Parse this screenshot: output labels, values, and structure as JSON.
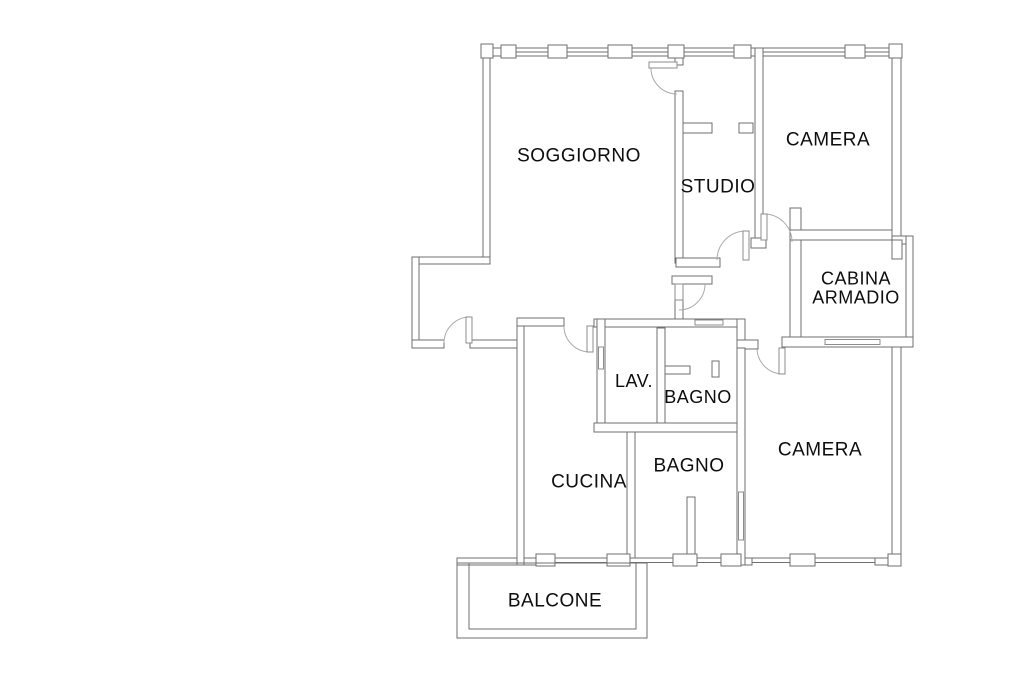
{
  "canvas": {
    "width": 1024,
    "height": 682,
    "background": "#ffffff"
  },
  "style": {
    "wall_fill": "#ffffff",
    "wall_stroke": "#6f6f6f",
    "arc_stroke": "#aaaaaa",
    "leaf_stroke": "#8c8c8c",
    "label_color": "#0d0d0d",
    "label_font_size": 19
  },
  "rooms": [
    {
      "id": "soggiorno",
      "label": "SOGGIORNO",
      "x": 579,
      "y": 156,
      "size": 19
    },
    {
      "id": "studio",
      "label": "STUDIO",
      "x": 718,
      "y": 187,
      "size": 19
    },
    {
      "id": "camera-top",
      "label": "CAMERA",
      "x": 828,
      "y": 140,
      "size": 19
    },
    {
      "id": "cabina-armadio",
      "label": "CABINA ARMADIO",
      "lines": [
        "CABINA",
        "ARMADIO"
      ],
      "x": 856,
      "y": 288,
      "line_height": 19,
      "size": 18
    },
    {
      "id": "lav",
      "label": "LAV.",
      "x": 634,
      "y": 381,
      "size": 18
    },
    {
      "id": "bagno-small",
      "label": "BAGNO",
      "x": 698,
      "y": 397,
      "size": 18
    },
    {
      "id": "cucina",
      "label": "CUCINA",
      "x": 589,
      "y": 482,
      "size": 19
    },
    {
      "id": "bagno-bottom",
      "label": "BAGNO",
      "x": 689,
      "y": 466,
      "size": 19
    },
    {
      "id": "camera-bottom",
      "label": "CAMERA",
      "x": 820,
      "y": 450,
      "size": 19
    },
    {
      "id": "balcone",
      "label": "BALCONE",
      "x": 555,
      "y": 601,
      "size": 19
    }
  ],
  "floorplan": {
    "walls": [
      {
        "n": "top-window-band",
        "r": [
          483,
          48,
          418,
          8
        ]
      },
      {
        "n": "bottom-wall-left",
        "r": [
          457,
          558,
          79,
          7
        ]
      },
      {
        "n": "bottom-wall-mid",
        "r": [
          723,
          558,
          29,
          7
        ]
      },
      {
        "n": "bottom-wall-right",
        "r": [
          875,
          558,
          25,
          7
        ]
      },
      {
        "n": "left-exterior-wall",
        "r": [
          483,
          48,
          7,
          214
        ]
      },
      {
        "n": "entry-north-wall",
        "r": [
          412,
          257,
          78,
          7
        ]
      },
      {
        "n": "entry-west-wall",
        "r": [
          412,
          257,
          7,
          90
        ]
      },
      {
        "n": "entry-south-wall-a",
        "r": [
          412,
          340,
          32,
          8
        ]
      },
      {
        "n": "entry-south-wall-b",
        "r": [
          470,
          340,
          53,
          8
        ]
      },
      {
        "n": "cucina-west-wall",
        "r": [
          517,
          318,
          7,
          247
        ]
      },
      {
        "n": "cucina-north-wall",
        "r": [
          517,
          318,
          47,
          8
        ]
      },
      {
        "n": "lav-bagno-north-wall",
        "r": [
          594,
          319,
          151,
          8
        ]
      },
      {
        "n": "lav-west-wall",
        "r": [
          597,
          319,
          8,
          113
        ]
      },
      {
        "n": "lav-bagno-divider",
        "r": [
          657,
          328,
          8,
          104
        ]
      },
      {
        "n": "lav-bagno-south-wall",
        "r": [
          594,
          423,
          151,
          9
        ]
      },
      {
        "n": "cucina-bagno-divider",
        "r": [
          627,
          432,
          8,
          131
        ]
      },
      {
        "n": "soggiorno-east-cap",
        "r": [
          675,
          48,
          8,
          17
        ]
      },
      {
        "n": "soggiorno-east-wall",
        "r": [
          675,
          91,
          8,
          172
        ]
      },
      {
        "n": "studio-south-wall",
        "r": [
          676,
          258,
          44,
          9
        ]
      },
      {
        "n": "hall-north-wall",
        "r": [
          672,
          276,
          40,
          8
        ]
      },
      {
        "n": "hall-stub-wall",
        "r": [
          675,
          298,
          8,
          21
        ]
      },
      {
        "n": "studio-east-wall",
        "r": [
          755,
          48,
          8,
          190
        ]
      },
      {
        "n": "studio-east-wall-cap",
        "r": [
          751,
          238,
          15,
          10
        ]
      },
      {
        "n": "cabina-west-wall",
        "r": [
          790,
          208,
          11,
          139
        ]
      },
      {
        "n": "camera-top-south-wall",
        "r": [
          790,
          230,
          106,
          10
        ]
      },
      {
        "n": "right-exterior-upper",
        "r": [
          892,
          48,
          9,
          190
        ]
      },
      {
        "n": "right-jut-wall",
        "r": [
          892,
          236,
          21,
          8
        ]
      },
      {
        "n": "cabina-east-wall",
        "r": [
          906,
          236,
          7,
          111
        ]
      },
      {
        "n": "cabina-notch-pier",
        "r": [
          892,
          240,
          10,
          19
        ]
      },
      {
        "n": "cabina-south-wall",
        "r": [
          782,
          337,
          131,
          10
        ]
      },
      {
        "n": "right-exterior-lower",
        "r": [
          892,
          347,
          9,
          218
        ]
      },
      {
        "n": "bagno-east-wall-top",
        "r": [
          737,
          319,
          8,
          29
        ]
      },
      {
        "n": "camera-bottom-jut",
        "r": [
          737,
          340,
          21,
          9
        ]
      },
      {
        "n": "bagno-camera-wall",
        "r": [
          737,
          348,
          8,
          217
        ]
      },
      {
        "n": "studio-stub-left",
        "r": [
          683,
          123,
          29,
          10
        ]
      },
      {
        "n": "studio-stub-right",
        "r": [
          739,
          123,
          14,
          10
        ]
      },
      {
        "n": "bagno-small-stub-h",
        "r": [
          665,
          366,
          25,
          8
        ]
      },
      {
        "n": "bagno-small-stub-v",
        "r": [
          712,
          361,
          7,
          16
        ]
      },
      {
        "n": "bagno-bottom-stub",
        "r": [
          687,
          497,
          8,
          61
        ]
      }
    ],
    "piers_top": [
      [
        481,
        44,
        12,
        14
      ],
      [
        501,
        45,
        15,
        13
      ],
      [
        548,
        45,
        19,
        13
      ],
      [
        608,
        45,
        24,
        13
      ],
      [
        668,
        45,
        16,
        13
      ],
      [
        734,
        45,
        17,
        13
      ],
      [
        845,
        45,
        20,
        13
      ],
      [
        889,
        44,
        13,
        14
      ]
    ],
    "piers_bottom": [
      [
        536,
        554,
        19,
        12
      ],
      [
        607,
        554,
        23,
        12
      ],
      [
        673,
        554,
        24,
        12
      ],
      [
        721,
        554,
        20,
        12
      ],
      [
        790,
        554,
        25,
        12
      ],
      [
        888,
        554,
        13,
        12
      ]
    ],
    "glaze_top_y": 52,
    "glaze_top_segments": [
      [
        513,
        548
      ],
      [
        567,
        608
      ],
      [
        632,
        668
      ],
      [
        684,
        734
      ],
      [
        763,
        845
      ],
      [
        865,
        889
      ]
    ],
    "windows_bottom_y": 558,
    "windows_bottom": [
      [
        555,
        52
      ],
      [
        630,
        43
      ],
      [
        697,
        24
      ],
      [
        752,
        38
      ],
      [
        815,
        60
      ]
    ],
    "balcony": {
      "outer": [
        457,
        563,
        190,
        75
      ],
      "inner": [
        469,
        563,
        167,
        66
      ]
    },
    "sliding_doors": [
      {
        "n": "lav-pocket-door",
        "r": [
          598.5,
          347,
          5,
          22
        ]
      },
      {
        "n": "bagno-sliding-door",
        "r": [
          695,
          320,
          28,
          5
        ]
      },
      {
        "n": "cabina-sliding-door",
        "r": [
          825,
          339.5,
          55,
          5
        ]
      },
      {
        "n": "camera-sliding-door",
        "r": [
          738.5,
          492,
          5,
          48
        ]
      }
    ],
    "doors": [
      {
        "n": "entrance-door",
        "leaf": [
          466,
          317,
          6,
          26
        ],
        "arc": "M444 343 A26 26 0 0 1 470 317"
      },
      {
        "n": "soggiorno-studio-door",
        "leaf": [
          649,
          62,
          28,
          6
        ],
        "arc": "M651 68 A26 26 0 0 0 677 94"
      },
      {
        "n": "studio-door",
        "leaf": [
          743,
          231,
          6,
          29
        ],
        "arc": "M717 260 A29 29 0 0 1 746 231"
      },
      {
        "n": "camera-top-door",
        "leaf": [
          761,
          214,
          6,
          26
        ],
        "arc": "M764 214 A28 28 0 0 1 792 242"
      },
      {
        "n": "hallway-door",
        "leaf": [
          675,
          284,
          8,
          16
        ],
        "arc": "M679 310 A26 26 0 0 0 705 284"
      },
      {
        "n": "cucina-door",
        "leaf": [
          587,
          326,
          6,
          26
        ],
        "arc": "M590 352 A26 26 0 0 1 564 326"
      },
      {
        "n": "camera-bottom-door",
        "leaf": [
          779,
          348,
          6,
          26
        ],
        "arc": "M757 348 A26 26 0 0 0 783 374"
      }
    ]
  }
}
